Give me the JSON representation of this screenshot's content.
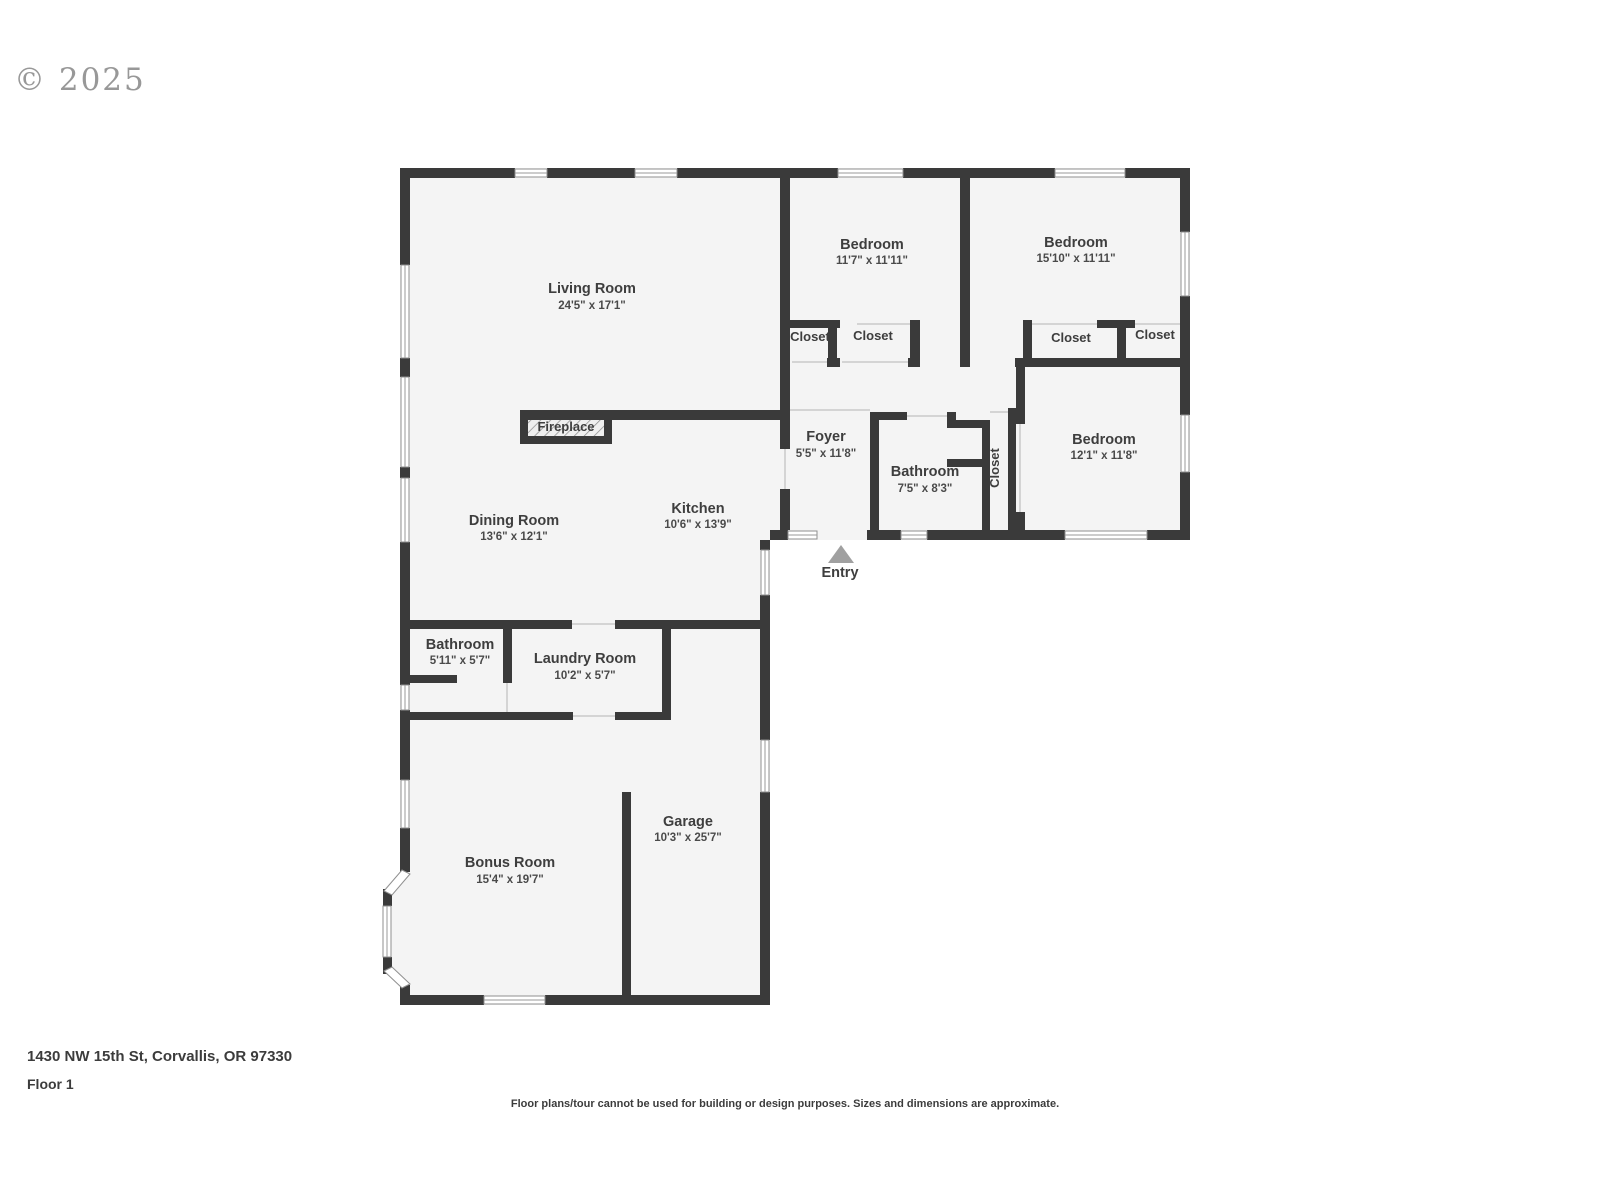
{
  "watermark": "© 2025",
  "rooms": [
    {
      "name": "Living Room",
      "dims": "24'5\" x 17'1\""
    },
    {
      "name": "Bedroom",
      "dims": "11'7\" x 11'11\""
    },
    {
      "name": "Bedroom",
      "dims": "15'10\" x 11'11\""
    },
    {
      "name": "Foyer",
      "dims": "5'5\" x 11'8\""
    },
    {
      "name": "Bathroom",
      "dims": "7'5\" x 8'3\""
    },
    {
      "name": "Bedroom",
      "dims": "12'1\" x 11'8\""
    },
    {
      "name": "Dining Room",
      "dims": "13'6\" x 12'1\""
    },
    {
      "name": "Kitchen",
      "dims": "10'6\" x 13'9\""
    },
    {
      "name": "Bathroom",
      "dims": "5'11\" x 5'7\""
    },
    {
      "name": "Laundry Room",
      "dims": "10'2\" x 5'7\""
    },
    {
      "name": "Garage",
      "dims": "10'3\" x 25'7\""
    },
    {
      "name": "Bonus Room",
      "dims": "15'4\" x 19'7\""
    }
  ],
  "labels": {
    "closet": "Closet",
    "fireplace": "Fireplace",
    "entry": "Entry"
  },
  "footer": {
    "address": "1430 NW 15th St, Corvallis, OR 97330",
    "floor_label": "Floor 1",
    "disclaimer": "Floor plans/tour cannot be used for building or design purposes. Sizes and dimensions are approximate."
  },
  "colors": {
    "wall": "#3a3a3a",
    "floor": "#f4f4f4",
    "text": "#3e3e3e",
    "watermark_gray": "#8d8d8d",
    "entry_arrow": "#a0a0a0"
  }
}
